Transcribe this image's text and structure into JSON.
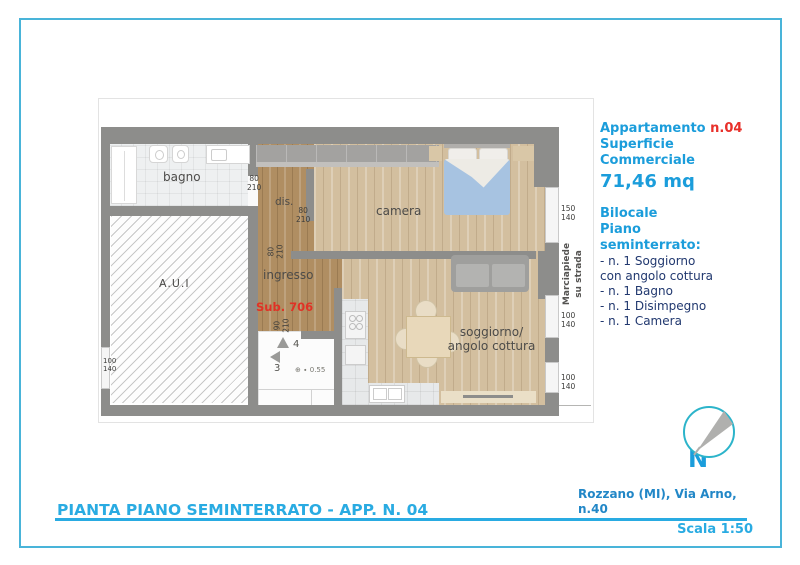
{
  "panel": {
    "apartment_label": "Appartamento",
    "apartment_number": "n.04",
    "surface_line1": "Superficie",
    "surface_line2": "Commerciale",
    "surface_value": "71,46 mq",
    "type_line1": "Bilocale",
    "type_line2": "Piano",
    "type_line3": "seminterrato:",
    "features": {
      "f1": "- n. 1 Soggiorno",
      "f2": "con angolo cottura",
      "f3": "- n. 1 Bagno",
      "f4": "- n. 1 Disimpegno",
      "f5": "- n. 1 Camera"
    }
  },
  "plan": {
    "rooms": {
      "bagno": "bagno",
      "dis": "dis.",
      "camera": "camera",
      "ingresso": "ingresso",
      "soggiorno_line1": "soggiorno/",
      "soggiorno_line2": "angolo cottura",
      "aui": "A.U.I",
      "sub": "Sub. 706"
    },
    "dims": {
      "bagno_door": {
        "w": "80",
        "h": "210"
      },
      "dis_door": {
        "w": "80",
        "h": "210"
      },
      "ingresso_door": {
        "w": "80",
        "h": "210"
      },
      "stair_door": {
        "w": "90",
        "h": "210"
      },
      "window_camera": {
        "w": "150",
        "h": "140"
      },
      "window_living1": {
        "w": "100",
        "h": "140"
      },
      "window_living2": {
        "w": "100",
        "h": "140"
      },
      "window_left": {
        "w": "100",
        "h": "140"
      }
    },
    "sidewalk_line1": "Marciapiede",
    "sidewalk_line2": "su strada",
    "stairs": {
      "step_low": "3",
      "step_high": "4",
      "level_value": "0.55"
    }
  },
  "icons": {
    "level_marker": "⊕",
    "level_dot": "∙"
  },
  "compass": {
    "north_label": "N"
  },
  "footer": {
    "title": "PIANTA PIANO SEMINTERRATO - APP. N. 04",
    "address_line1": "Rozzano (MI), Via Arno,",
    "address_line2": "n.40",
    "scale": "Scala 1:50"
  },
  "colors": {
    "accent_azure": "#29abe2",
    "accent_red": "#e8302a",
    "list_navy": "#21386f",
    "wall_gray": "#8d8d8b",
    "compass_teal": "#2cb4ca",
    "frame_blue": "#49b4d9"
  }
}
